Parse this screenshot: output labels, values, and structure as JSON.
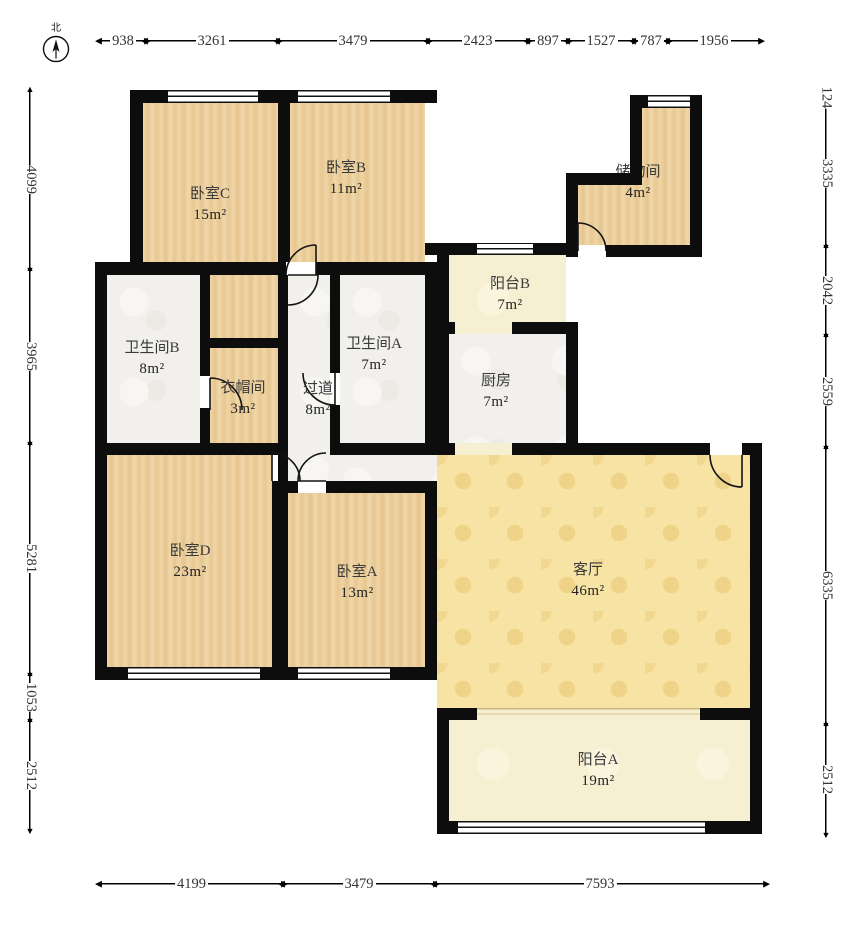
{
  "compass": {
    "north_label": "北"
  },
  "rooms": {
    "bedroom_c": {
      "name": "卧室C",
      "area": "15m²"
    },
    "bedroom_b": {
      "name": "卧室B",
      "area": "11m²"
    },
    "storage": {
      "name": "储物间",
      "area": "4m²"
    },
    "balcony_b": {
      "name": "阳台B",
      "area": "7m²"
    },
    "bathroom_b": {
      "name": "卫生间B",
      "area": "8m²"
    },
    "cloakroom": {
      "name": "衣帽间",
      "area": "3m²"
    },
    "bathroom_a": {
      "name": "卫生间A",
      "area": "7m²"
    },
    "hallway": {
      "name": "过道",
      "area": "8m²"
    },
    "kitchen": {
      "name": "厨房",
      "area": "7m²"
    },
    "bedroom_d": {
      "name": "卧室D",
      "area": "23m²"
    },
    "bedroom_a": {
      "name": "卧室A",
      "area": "13m²"
    },
    "living_room": {
      "name": "客厅",
      "area": "46m²"
    },
    "balcony_a": {
      "name": "阳台A",
      "area": "19m²"
    }
  },
  "dimensions": {
    "top": [
      "938",
      "3261",
      "3479",
      "2423",
      "897",
      "1527",
      "787",
      "1956"
    ],
    "left": [
      "4099",
      "3965",
      "5281",
      "1053",
      "2512"
    ],
    "right": [
      "124",
      "3335",
      "2042",
      "2559",
      "6335",
      "2512"
    ],
    "bottom": [
      "4199",
      "3479",
      "7593"
    ]
  },
  "colors": {
    "wall": "#0d0d0d",
    "wood_floor": "#eacb96",
    "tile_floor": "#f1f0ec",
    "balcony_floor": "#f6efd2",
    "living_floor": "#f7e3a4"
  }
}
